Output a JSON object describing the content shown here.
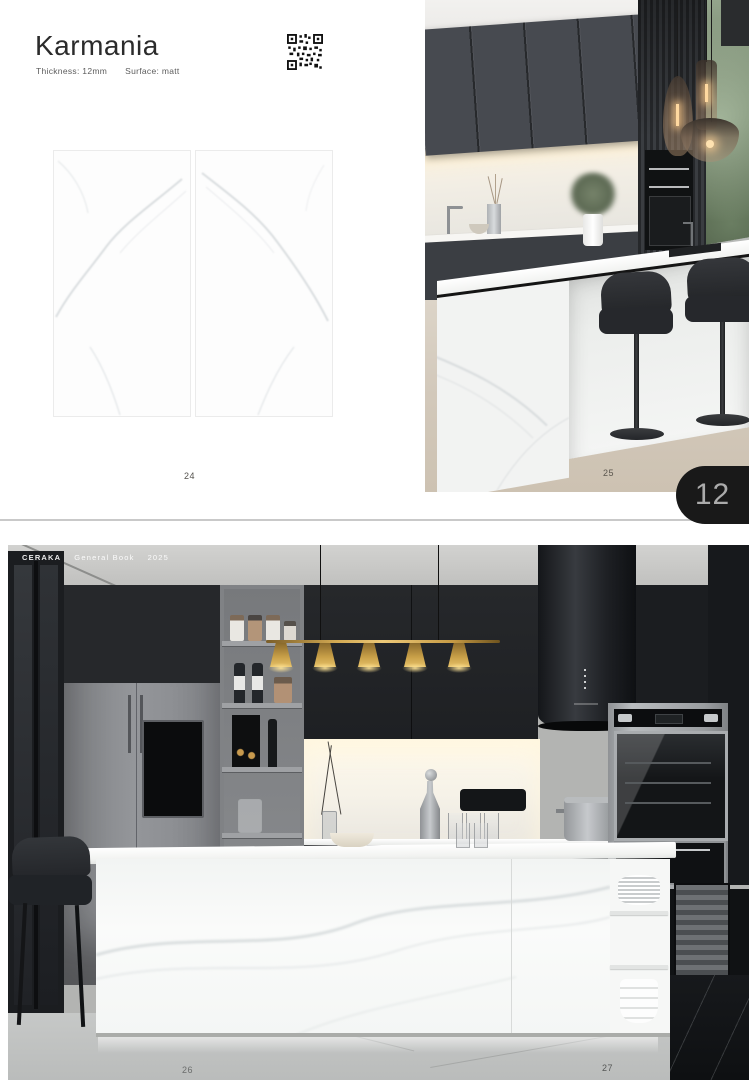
{
  "spread_top": {
    "product": {
      "title": "Karmania",
      "thickness": "Thickness: 12mm",
      "surface": "Surface: matt"
    },
    "page_left": "24",
    "page_right": "25"
  },
  "page_tab": {
    "number": "12"
  },
  "spread_bottom": {
    "header": {
      "brand": "CERAKA",
      "book": "General Book",
      "year": "2025"
    },
    "page_left": "26",
    "page_right": "27"
  },
  "colors": {
    "tab_background": "#191919",
    "tab_text": "#ababab",
    "divider": "#c9c9c9",
    "gold_pendant": "#cda24c"
  }
}
